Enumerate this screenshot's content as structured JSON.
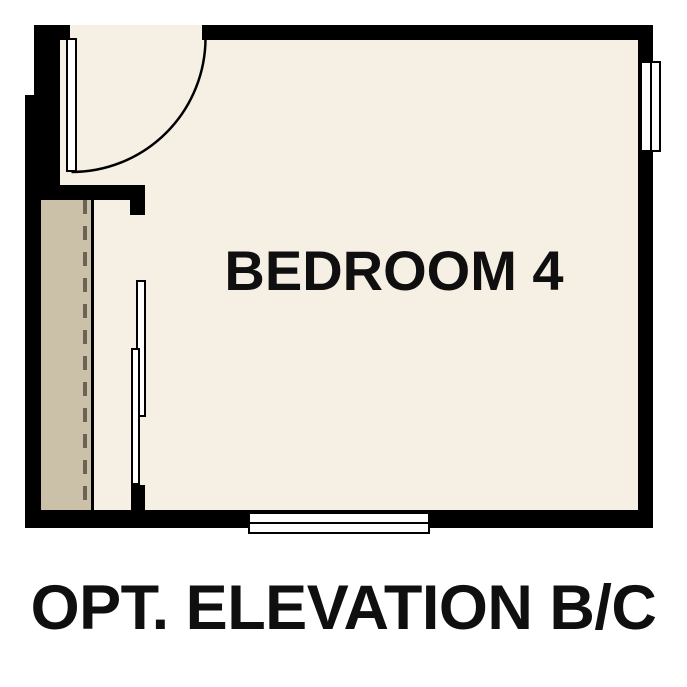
{
  "plan": {
    "room_label": "BEDROOM 4",
    "caption": "OPT. ELEVATION B/C"
  },
  "colors": {
    "background": "#ffffff",
    "wall": "#000000",
    "floor": "#f6efe3",
    "closet_floor": "#cbc0a8",
    "dashed_line": "#6b6353",
    "symbol_fill": "#ffffff",
    "text": "#0f0f0f"
  }
}
